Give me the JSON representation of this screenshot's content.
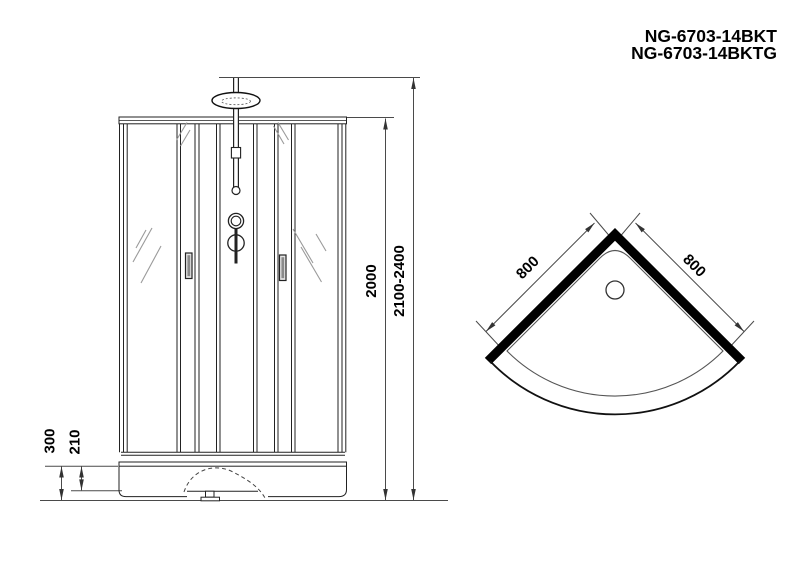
{
  "header": {
    "model_line1": "NG-6703-14BKT",
    "model_line2": "NG-6703-14BKTG"
  },
  "front_view": {
    "dimensions": {
      "glass_height": "2000",
      "total_height": "2100-2400",
      "base_height": "300",
      "tray_height": "210"
    }
  },
  "top_view": {
    "dimensions": {
      "left_side": "800",
      "right_side": "800"
    }
  },
  "colors": {
    "ink": "#000000",
    "thin_line": "#4a4a4a",
    "structure_line": "#222222",
    "wall_fill": "#000000",
    "glass_mark": "#9a9a9a",
    "background": "#ffffff"
  }
}
